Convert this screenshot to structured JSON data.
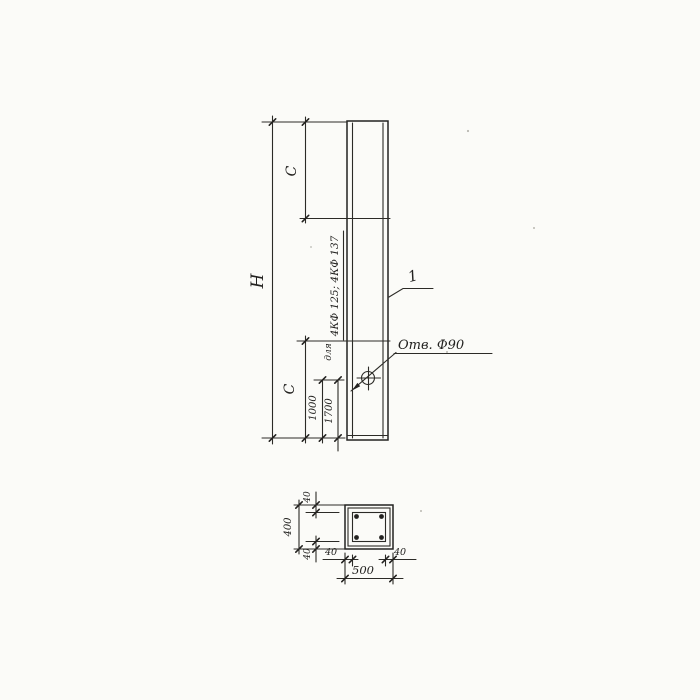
{
  "colors": {
    "paper": "#fbfbf8",
    "ink": "#2c2b27"
  },
  "elevation": {
    "height_label": "H",
    "upper_zone_label": "C",
    "lower_zone_label": "C",
    "hole_offset_primary": "1000",
    "hole_offset_alternate": "1700",
    "applicability_prefix": "для",
    "column_marks_note": "4КФ 125; 4КФ 137",
    "hole_callout": "Отв. Ф90",
    "part_number_callout": "1"
  },
  "section": {
    "overall_height": "400",
    "overall_width": "500",
    "cover_top": "40",
    "cover_bottom": "40",
    "cover_left": "40",
    "cover_right": "40"
  }
}
